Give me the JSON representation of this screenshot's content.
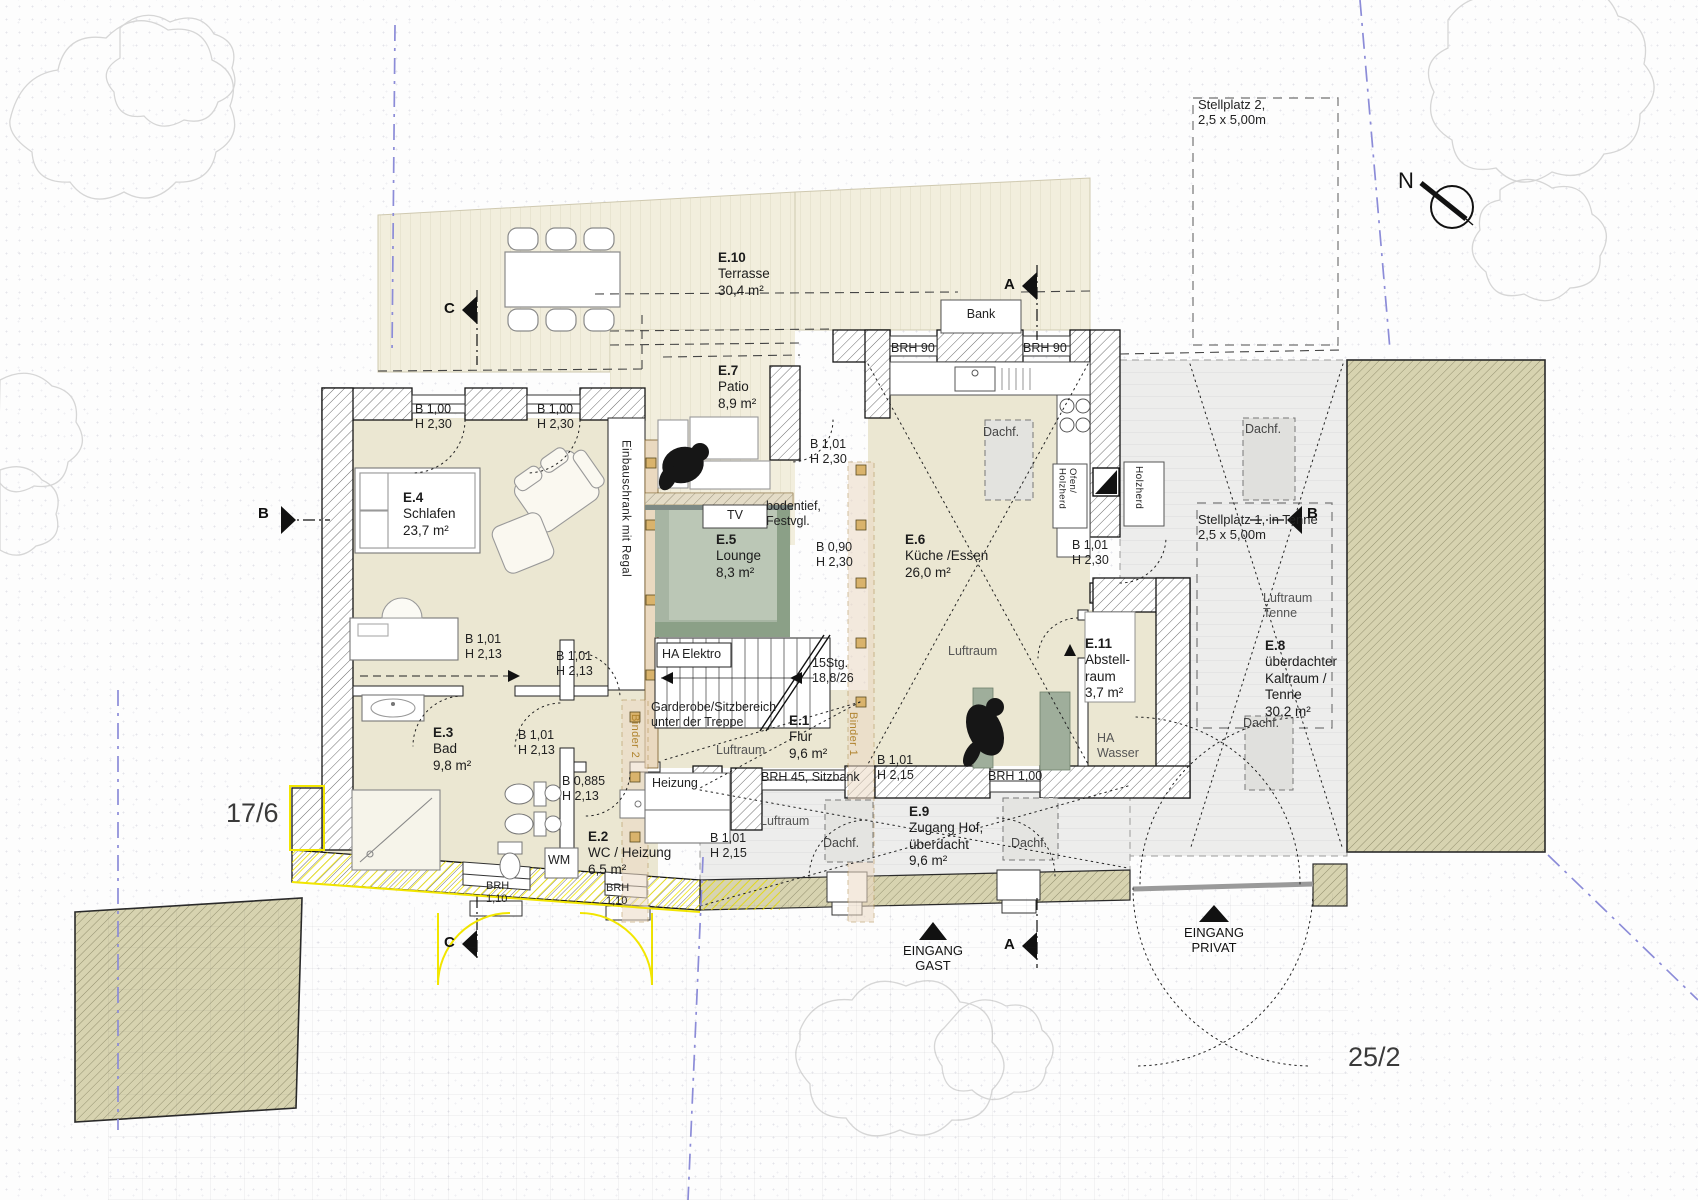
{
  "meta": {
    "north_label": "N",
    "parcel_left": "17/6",
    "parcel_right": "25/2"
  },
  "sections": {
    "a": "A",
    "b": "B",
    "c": "C"
  },
  "entrances": [
    {
      "label": "EINGANG\nGAST"
    },
    {
      "label": "EINGANG\nPRIVAT"
    }
  ],
  "stellplatz": [
    {
      "text": "Stellplatz 2,\n2,5 x 5,00m"
    },
    {
      "text": "Stellplatz 1, in Tenne\n2,5 x 5,00m"
    }
  ],
  "rooms": [
    {
      "id": "E.10",
      "name": "Terrasse",
      "area": "30,4 m²"
    },
    {
      "id": "E.7",
      "name": "Patio",
      "area": "8,9 m²"
    },
    {
      "id": "E.4",
      "name": "Schlafen",
      "area": "23,7 m²"
    },
    {
      "id": "E.5",
      "name": "Lounge",
      "area": "8,3 m²"
    },
    {
      "id": "E.6",
      "name": "Küche /Essen",
      "area": "26,0 m²"
    },
    {
      "id": "E.3",
      "name": "Bad",
      "area": "9,8 m²"
    },
    {
      "id": "E.2",
      "name": "WC / Heizung",
      "area": "6,5 m²"
    },
    {
      "id": "E.1",
      "name": "Flur",
      "area": "9,6 m²"
    },
    {
      "id": "E.11",
      "name": "Abstell-\nraum",
      "area": "3,7 m²"
    },
    {
      "id": "E.9",
      "name": "Zugang Hof,\nüberdacht",
      "area": "9,6 m²"
    },
    {
      "id": "E.8",
      "name": "überdachter\nKaltraum /\nTenne",
      "area": "30,2 m²"
    }
  ],
  "labels": [
    {
      "text": "B 1,00\nH 2,30"
    },
    {
      "text": "B 1,00\nH 2,30"
    },
    {
      "text": "B 1,01\nH 2,30"
    },
    {
      "text": "B 0,90\nH 2,30"
    },
    {
      "text": "B 1,01\nH 2,30"
    },
    {
      "text": "B 1,01\nH 2,13"
    },
    {
      "text": "B 1,01\nH 2,13"
    },
    {
      "text": "B 1,01\nH 2,13"
    },
    {
      "text": "B 0,885\nH 2,13"
    },
    {
      "text": "B 1,01\nH 2,15"
    },
    {
      "text": "B 1,01\nH 2,15"
    },
    {
      "text": "BRH 90"
    },
    {
      "text": "BRH 90"
    },
    {
      "text": "BRH 45, Sitzbank"
    },
    {
      "text": "BRH 1,00"
    },
    {
      "text": "BRH\n1,10"
    },
    {
      "text": "BRH\n1,10"
    },
    {
      "text": "15Stg.\n18,8/26"
    },
    {
      "text": "Bank"
    },
    {
      "text": "TV"
    },
    {
      "text": "bodentief,\nFestvgl."
    },
    {
      "text": "HA Elektro"
    },
    {
      "text": "Garderobe/Sitzbereich\nunter der Treppe"
    },
    {
      "text": "Heizung"
    },
    {
      "text": "HA\nWasser"
    },
    {
      "text": "Luftraum"
    },
    {
      "text": "Luftraum"
    },
    {
      "text": "Luftraum"
    },
    {
      "text": "Luftraum\nTenne"
    },
    {
      "text": "Dachf."
    },
    {
      "text": "Dachf."
    },
    {
      "text": "Dachf."
    },
    {
      "text": "Dachf."
    },
    {
      "text": "Dachf."
    },
    {
      "text": "Ofen/\nHolzherd"
    },
    {
      "text": "Holzherd"
    },
    {
      "text": "Einbauschrank mit Regal"
    },
    {
      "text": "Binder 2"
    },
    {
      "text": "Binder 1"
    },
    {
      "text": "WM"
    }
  ],
  "colors": {
    "floor_cream": "#ebe7d2",
    "deck": "#f2eedd",
    "lounge_green": "#a7b5a3",
    "gray_zone": "#ededec",
    "neighbor_khaki": "#d7d3b0",
    "demolition_yellow": "#f2e600",
    "boundary_violet": "#8c8cd8",
    "binder_tan": "#ecd9c4"
  }
}
